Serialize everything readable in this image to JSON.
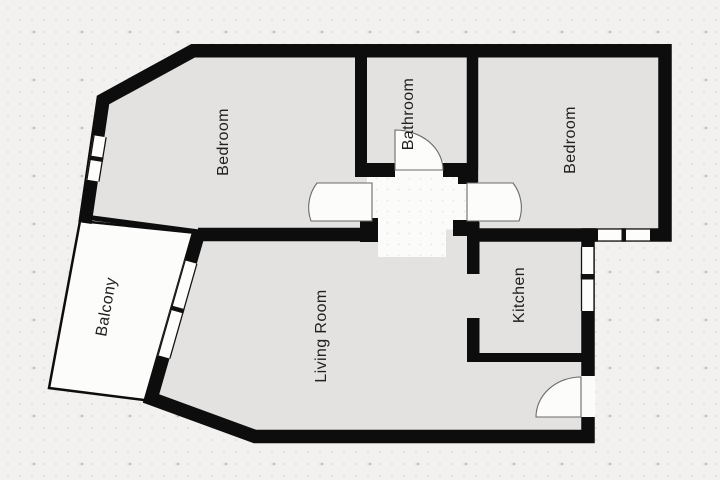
{
  "floorplan": {
    "rooms": [
      {
        "id": "bedroom-left",
        "label": "Bedroom"
      },
      {
        "id": "bathroom",
        "label": "Bathroom"
      },
      {
        "id": "bedroom-right",
        "label": "Bedroom"
      },
      {
        "id": "kitchen",
        "label": "Kitchen"
      },
      {
        "id": "living-room",
        "label": "Living Room"
      },
      {
        "id": "balcony",
        "label": "Balcony"
      }
    ],
    "colors": {
      "wall": "#0d0d0d",
      "room_fill": "#e3e2e1",
      "outdoor_fill": "#fcfcfb",
      "background": "#f2f1ef",
      "label_text": "#202020",
      "door_arc": "#6a6a6a"
    }
  }
}
